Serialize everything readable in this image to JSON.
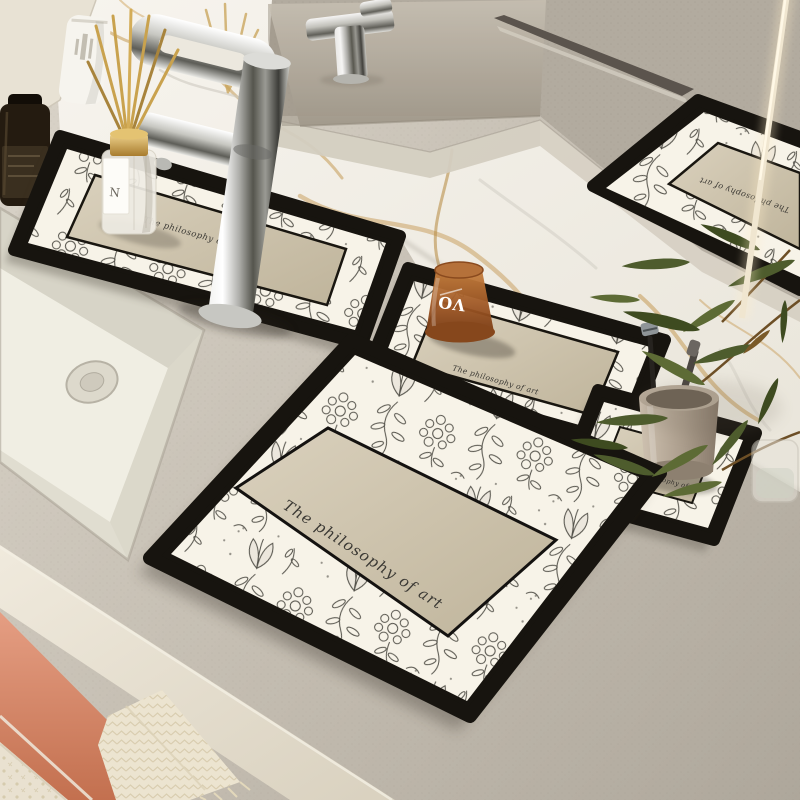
{
  "mats": {
    "brand_text": "The philosophy of art"
  },
  "cup": {
    "logo": "VO"
  },
  "diffuser": {
    "label_letter": "N"
  },
  "palette": {
    "counter": "#c5beb2",
    "marble": "#f3f0e9",
    "marble_vein_gold": "#c59a55",
    "mat_border": "#17140f",
    "mat_field": "#f7f3e8",
    "mat_panel": "#cfc5ae",
    "toile_print": "#35332c",
    "text": "#3b3934",
    "cup_amber": "#a95f2b",
    "cup_logo_white": "#ffffff",
    "holder_taupe": "#a89a88",
    "drawer_coral": "#d88c70",
    "towel_cream": "#ece4d0",
    "plant_green": "#4e5c2d",
    "reed_gold": "#c9a24e",
    "chrome": "#c9c9c5"
  }
}
